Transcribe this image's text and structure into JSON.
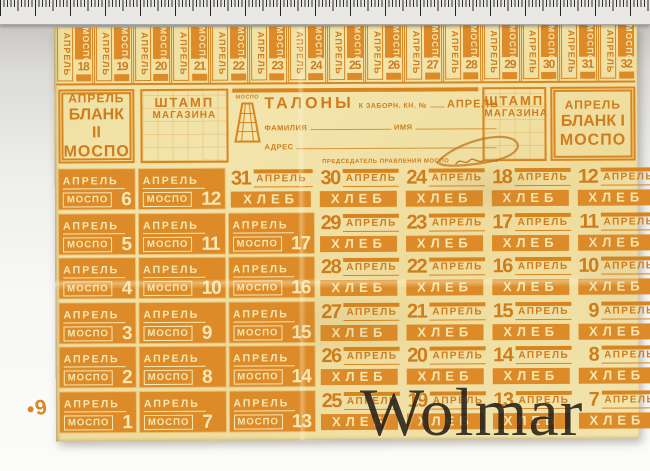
{
  "watermark": "Wolmar",
  "margin_note": "•9",
  "top_strip": {
    "numbers": [
      18,
      19,
      20,
      21,
      22,
      23,
      24,
      25,
      26,
      27,
      28,
      29,
      30,
      31,
      32
    ]
  },
  "coupon_labels": {
    "month": "АПРЕЛЬ",
    "org": "МОСПО",
    "product": "ХЛЕБ"
  },
  "header": {
    "blank_left": {
      "month": "АПРЕЛЬ",
      "blank": "БЛАНК II",
      "org": "МОСПО"
    },
    "stamp_left": {
      "line1": "ШТАМП",
      "line2": "МАГАЗИНА"
    },
    "center": {
      "logo_org": "МОСПО",
      "title": "ТАЛОНЫ",
      "book_label": "К ЗАБОРН. КН. №",
      "month": "АПРЕЛЬ",
      "surname_label": "ФАМИЛИЯ",
      "name_label": "ИМЯ",
      "address_label": "АДРЕС",
      "chairman_label": "ПРЕДСЕДАТЕЛЬ ПРАВЛЕНИЯ МОСПО"
    },
    "stamp_right": {
      "line1": "ШТАМП",
      "line2": "МАГАЗИНА"
    },
    "blank_right": {
      "month": "АПРЕЛЬ",
      "blank": "БЛАНК I",
      "org": "МОСПО"
    }
  },
  "grid_rows": [
    [
      {
        "type": "mospo",
        "num": 6
      },
      {
        "type": "mospo",
        "num": 12
      },
      {
        "type": "bread",
        "num": 31
      },
      {
        "type": "bread",
        "num": 30
      },
      {
        "type": "bread",
        "num": 24
      },
      {
        "type": "bread",
        "num": 18
      },
      {
        "type": "bread",
        "num": 12
      },
      {
        "type": "bread",
        "num": 6
      }
    ],
    [
      {
        "type": "mospo",
        "num": 5
      },
      {
        "type": "mospo",
        "num": 11
      },
      {
        "type": "mospo",
        "num": 17
      },
      {
        "type": "bread",
        "num": 29
      },
      {
        "type": "bread",
        "num": 23
      },
      {
        "type": "bread",
        "num": 17
      },
      {
        "type": "bread",
        "num": 11
      },
      {
        "type": "bread",
        "num": 5
      }
    ],
    [
      {
        "type": "mospo",
        "num": 4
      },
      {
        "type": "mospo",
        "num": 10
      },
      {
        "type": "mospo",
        "num": 16
      },
      {
        "type": "bread",
        "num": 28
      },
      {
        "type": "bread",
        "num": 22
      },
      {
        "type": "bread",
        "num": 16
      },
      {
        "type": "bread",
        "num": 10
      },
      {
        "type": "bread",
        "num": 4
      }
    ],
    [
      {
        "type": "mospo",
        "num": 3
      },
      {
        "type": "mospo",
        "num": 9
      },
      {
        "type": "mospo",
        "num": 15
      },
      {
        "type": "bread",
        "num": 27
      },
      {
        "type": "bread",
        "num": 21
      },
      {
        "type": "bread",
        "num": 15
      },
      {
        "type": "bread",
        "num": 9
      },
      {
        "type": "bread",
        "num": 3
      }
    ],
    [
      {
        "type": "mospo",
        "num": 2
      },
      {
        "type": "mospo",
        "num": 8
      },
      {
        "type": "mospo",
        "num": 14
      },
      {
        "type": "bread",
        "num": 26
      },
      {
        "type": "bread",
        "num": 20
      },
      {
        "type": "bread",
        "num": 14
      },
      {
        "type": "bread",
        "num": 8
      },
      {
        "type": "bread",
        "num": 2
      }
    ],
    [
      {
        "type": "mospo",
        "num": 1
      },
      {
        "type": "mospo",
        "num": 7
      },
      {
        "type": "mospo",
        "num": 13
      },
      {
        "type": "bread",
        "num": 25
      },
      {
        "type": "bread",
        "num": 19
      },
      {
        "type": "bread",
        "num": 13
      },
      {
        "type": "bread",
        "num": 7
      },
      {
        "type": "bread",
        "num": 1
      }
    ]
  ],
  "colors": {
    "paper": "#f0e1a4",
    "ink": "#d8851f",
    "knockout": "#f5e8b4",
    "watermark": "rgba(28,22,12,0.84)"
  }
}
